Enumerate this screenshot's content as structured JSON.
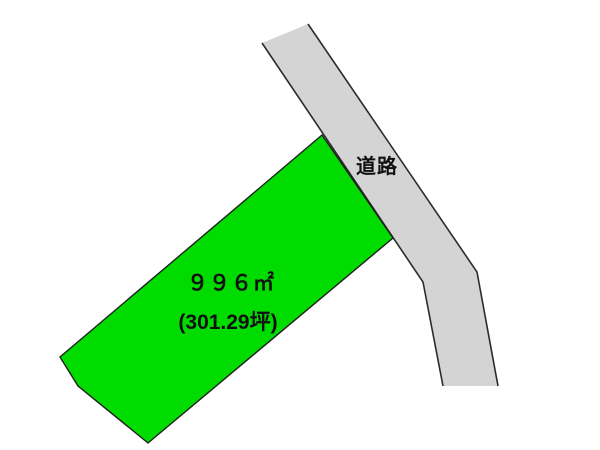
{
  "page": {
    "background_color": "#ffffff",
    "width": 600,
    "height": 450
  },
  "parcel": {
    "area_m2": "９９６㎡",
    "area_tsubo": "(301.29坪)",
    "fill_color": "#00dc00"
  },
  "road": {
    "label": "道路",
    "fill_color": "#d4d4d4"
  }
}
